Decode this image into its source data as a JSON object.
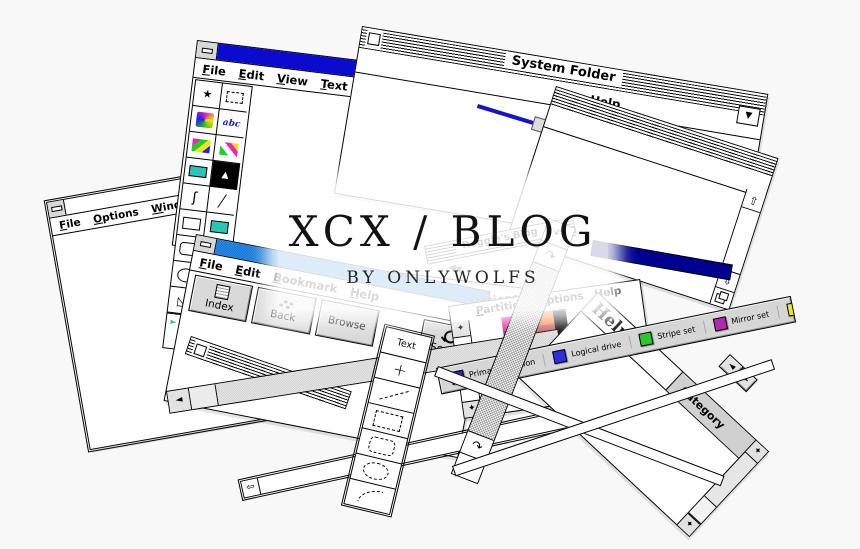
{
  "background_color": "#f8f8f8",
  "banner": {
    "title": "XCX / BLOG",
    "subtitle": "BY ONLYWOLFS"
  },
  "paintbrush_window": {
    "menu": {
      "file": "File",
      "edit": "Edit",
      "view": "View",
      "text": "Text",
      "pick": "Pick",
      "options": "Options",
      "help": "Help"
    },
    "pick_disabled": true,
    "title_bar_color": "#0b0bcf",
    "tool_accent_color": "#2cc4b4",
    "text_tool_label": "abc",
    "brush_glyph": "▲",
    "curve_glyph": "ʃ",
    "line_glyph": "╱",
    "polygon_glyph": "◺",
    "filled_polygon_glyph": "◣",
    "pick_star_glyph": "★",
    "linewidth_arrow": "►",
    "tools": [
      "freeform-pick",
      "pick",
      "airbrush",
      "text",
      "color-eraser",
      "eraser",
      "paint-roller",
      "brush",
      "curve",
      "line",
      "rectangle",
      "filled-rectangle",
      "rounded-rectangle",
      "filled-rounded-rectangle",
      "ellipse",
      "filled-ellipse",
      "polygon",
      "filled-polygon",
      "line-width-selector"
    ]
  },
  "system_folder_window": {
    "title": "System Folder",
    "menu": {
      "help": "Help"
    },
    "dropdown_glyph": "▼"
  },
  "mac_window": {
    "scroll_up_glyph": "⇧",
    "scroll_down_glyph": "⇩"
  },
  "help_window": {
    "title_bar_color": "#1b7fd4",
    "menu": {
      "file": "File",
      "edit": "Edit",
      "bookmark": "Bookmark",
      "help": "Help"
    },
    "buttons": {
      "index": "Index",
      "back": "Back",
      "browse": "Browse",
      "search": "Search"
    }
  },
  "file_options_window": {
    "menu": {
      "file": "File",
      "options": "Options",
      "window": "Window"
    }
  },
  "partition_window": {
    "menu": {
      "partition": "Partition",
      "options": "Options",
      "help": "Help"
    },
    "plus_glyph": "+",
    "scroll_arrow_glyph": "✦",
    "swatch_colors": [
      "#ef1a96",
      "#f58332",
      "#7c35c9",
      "#c95f63",
      "#000000"
    ]
  },
  "disk_legend": {
    "items": [
      {
        "label": "Primary partition",
        "color": "#2a2ab0"
      },
      {
        "label": "Logical drive",
        "color": "#2e2ee0"
      },
      {
        "label": "Stripe set",
        "color": "#2ec82e"
      },
      {
        "label": "Mirror set",
        "color": "#b02ab0"
      },
      {
        "label": "Volume set",
        "color": "#e8e82a"
      }
    ]
  },
  "draw_palette": {
    "text_label": "Text",
    "crosshair_label": "+",
    "cells": [
      "text",
      "crosshair",
      "line",
      "rectangle",
      "rounded-rectangle",
      "ellipse",
      "arc"
    ]
  },
  "category_window": {
    "title": "Help",
    "column_header": "Category",
    "scroll_left_glyph": "◄",
    "scroll_right_glyph": "►",
    "scroll_arrow_glyph": "✦"
  },
  "scrollbars": {
    "gray_left_arrow": "◄",
    "mac_left_arrow": "⇦",
    "curl_back_glyph": "↶",
    "curl_fwd_glyph": "↷"
  },
  "faded_fragments": {
    "reggies_title": "Reggie's Blog",
    "options": "Options",
    "help": "Help",
    "time": "Time",
    "rewind": "◀◀"
  }
}
